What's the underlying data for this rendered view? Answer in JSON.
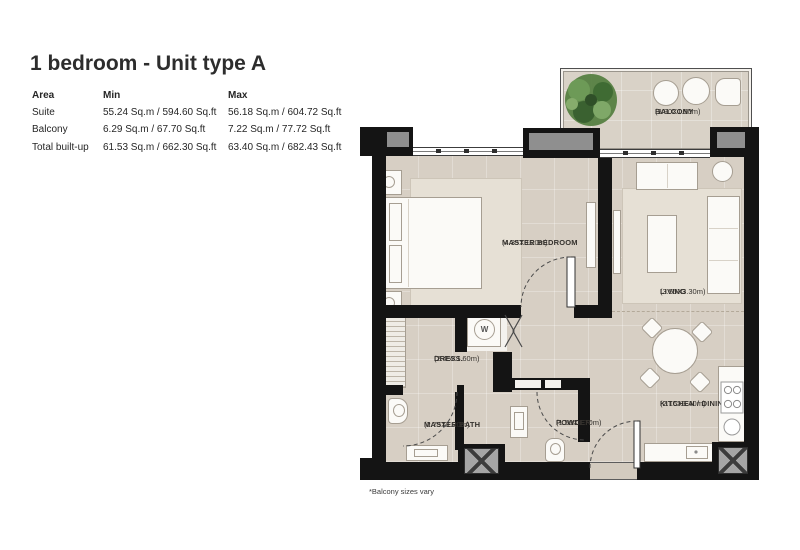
{
  "title": "1 bedroom - Unit type A",
  "table": {
    "headers": [
      "Area",
      "Min",
      "Max"
    ],
    "rows": [
      {
        "area": "Suite",
        "min": "55.24 Sq.m / 594.60 Sq.ft",
        "max": "56.18 Sq.m / 604.72 Sq.ft"
      },
      {
        "area": "Balcony",
        "min": "6.29 Sq.m / 67.70 Sq.ft",
        "max": "7.22 Sq.m / 77.72 Sq.ft"
      },
      {
        "area": "Total built-up",
        "min": "61.53 Sq.m / 662.30 Sq.ft",
        "max": "63.40 Sq.m / 682.43 Sq.ft"
      }
    ]
  },
  "plan": {
    "rooms": {
      "balcony": {
        "name": "BALCONY",
        "dims": "(3.90X1.50m)"
      },
      "master_bedroom": {
        "name": "MASTER BEDROOM",
        "dims": "(4.35X3.20m)"
      },
      "living": {
        "name": "LIVING",
        "dims": "(3.55X3.30m)"
      },
      "kitchen_dining": {
        "name": "KITCHEN / DINING",
        "dims": "(2.15X3.40m)"
      },
      "dress": {
        "name": "DRESS.",
        "dims": "(2.45X1.60m)"
      },
      "master_bath": {
        "name": "MASTER BATH",
        "dims": "(2.75X1.20m)"
      },
      "powder": {
        "name": "POWDER",
        "dims": "(1.50X1.70m)"
      }
    },
    "washer_label": "W",
    "colors": {
      "wall": "#141414",
      "floor": "#d7cfc4",
      "pillar_inset": "#8f8f8f",
      "rug": "#e6e0d5"
    }
  },
  "note": "*Balcony sizes vary"
}
